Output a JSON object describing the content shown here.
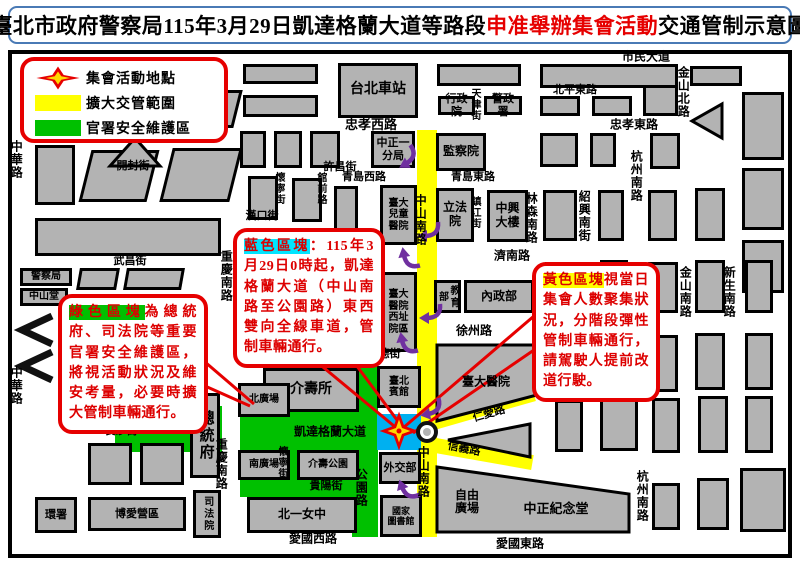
{
  "title": {
    "part1": "臺北市政府警察局115年3月29日凱達格蘭大道等路段",
    "accent": "申准舉辦集會活動",
    "part2": "交通管制示意圖"
  },
  "legend": {
    "items": [
      {
        "icon": "assembly-star-icon",
        "label": "集會活動地點"
      },
      {
        "icon": "yellow-zone-swatch",
        "label": "擴大交管範圍"
      },
      {
        "icon": "green-zone-swatch",
        "label": "官署安全維護區"
      }
    ]
  },
  "colors": {
    "building_gray": "#b3b3b3",
    "zone_yellow": "#ffff00",
    "zone_green": "#00c000",
    "zone_blue": "#00b0f0",
    "callout_red": "#e60000",
    "arrow_purple": "#7030a0",
    "title_border_blue": "#4a7ab5",
    "highlight_cyan": "#00e5ff",
    "star_red": "#e60000",
    "star_yellow": "#ffd800"
  },
  "map": {
    "zones": [
      {
        "n": "zone-yellow-zhongshan-s-rd",
        "x": 417,
        "y": 130,
        "w": 20,
        "h": 407,
        "c": "#ffff00"
      },
      {
        "n": "zone-yellow-renai-rd",
        "x": 430,
        "y": 416,
        "w": 108,
        "h": 15,
        "c": "#ffff00",
        "r": -16
      },
      {
        "n": "zone-yellow-xinyi-rd",
        "x": 430,
        "y": 437,
        "w": 104,
        "h": 15,
        "c": "#ffff00",
        "r": 10
      },
      {
        "n": "zone-green-west",
        "x": 115,
        "y": 406,
        "w": 107,
        "h": 46,
        "c": "#00c000"
      },
      {
        "n": "zone-green-ketagalan",
        "x": 240,
        "y": 410,
        "w": 138,
        "h": 42,
        "c": "#00c000"
      },
      {
        "n": "zone-green-south",
        "x": 240,
        "y": 452,
        "w": 138,
        "h": 45,
        "c": "#00c000"
      },
      {
        "n": "zone-green-gongyuan-n",
        "x": 352,
        "y": 362,
        "w": 26,
        "h": 48,
        "c": "#00c000"
      },
      {
        "n": "zone-green-gongyuan-s",
        "x": 352,
        "y": 497,
        "w": 26,
        "h": 40,
        "c": "#00c000"
      },
      {
        "n": "zone-blue-assembly",
        "x": 377,
        "y": 414,
        "w": 44,
        "h": 36,
        "c": "#00b0f0"
      }
    ],
    "buildings": [
      {
        "x": 35,
        "y": 88,
        "w": 40,
        "h": 45
      },
      {
        "x": 80,
        "y": 90,
        "w": 73,
        "h": 38,
        "sk": -14
      },
      {
        "x": 162,
        "y": 90,
        "w": 76,
        "h": 38,
        "sk": -14
      },
      {
        "x": 35,
        "y": 145,
        "w": 40,
        "h": 60
      },
      {
        "x": 85,
        "y": 150,
        "w": 68,
        "h": 52,
        "sk": -14
      },
      {
        "x": 166,
        "y": 148,
        "w": 70,
        "h": 54,
        "sk": -14
      },
      {
        "x": 35,
        "y": 218,
        "w": 186,
        "h": 38
      },
      {
        "x": 243,
        "y": 64,
        "w": 75,
        "h": 20
      },
      {
        "x": 243,
        "y": 95,
        "w": 75,
        "h": 22
      },
      {
        "x": 338,
        "y": 63,
        "w": 80,
        "h": 55,
        "t": "台北車站",
        "fs": 14
      },
      {
        "x": 437,
        "y": 64,
        "w": 84,
        "h": 22
      },
      {
        "x": 438,
        "y": 96,
        "w": 37,
        "h": 19,
        "t": "行政院",
        "fs": 11
      },
      {
        "x": 484,
        "y": 96,
        "w": 38,
        "h": 19,
        "t": "警政署",
        "fs": 11
      },
      {
        "x": 540,
        "y": 64,
        "w": 138,
        "h": 24
      },
      {
        "x": 540,
        "y": 96,
        "w": 40,
        "h": 20
      },
      {
        "x": 592,
        "y": 96,
        "w": 40,
        "h": 20
      },
      {
        "x": 643,
        "y": 85,
        "w": 35,
        "h": 31
      },
      {
        "x": 690,
        "y": 66,
        "w": 52,
        "h": 20
      },
      {
        "x": 742,
        "y": 92,
        "w": 42,
        "h": 68
      },
      {
        "x": 240,
        "y": 131,
        "w": 26,
        "h": 37
      },
      {
        "x": 274,
        "y": 131,
        "w": 28,
        "h": 37
      },
      {
        "x": 310,
        "y": 131,
        "w": 30,
        "h": 37
      },
      {
        "x": 371,
        "y": 131,
        "w": 44,
        "h": 37,
        "t": "中正一\n分局",
        "fs": 11
      },
      {
        "x": 436,
        "y": 133,
        "w": 50,
        "h": 38,
        "t": "監察院",
        "fs": 12
      },
      {
        "x": 540,
        "y": 133,
        "w": 38,
        "h": 34
      },
      {
        "x": 590,
        "y": 133,
        "w": 26,
        "h": 34
      },
      {
        "x": 650,
        "y": 133,
        "w": 30,
        "h": 36
      },
      {
        "x": 742,
        "y": 168,
        "w": 42,
        "h": 62
      },
      {
        "x": 248,
        "y": 176,
        "w": 30,
        "h": 44
      },
      {
        "x": 292,
        "y": 178,
        "w": 30,
        "h": 44
      },
      {
        "x": 334,
        "y": 186,
        "w": 24,
        "h": 56
      },
      {
        "x": 334,
        "y": 250,
        "w": 24,
        "h": 58
      },
      {
        "x": 334,
        "y": 312,
        "w": 22,
        "h": 40
      },
      {
        "x": 380,
        "y": 185,
        "w": 37,
        "h": 60,
        "t": "臺大\n兒童\n醫院",
        "fs": 10
      },
      {
        "x": 380,
        "y": 272,
        "w": 37,
        "h": 80,
        "t": "臺大\n醫院\n西址\n院區",
        "fs": 10
      },
      {
        "x": 436,
        "y": 188,
        "w": 38,
        "h": 54,
        "t": "立法院",
        "fs": 12
      },
      {
        "x": 487,
        "y": 190,
        "w": 41,
        "h": 52,
        "t": "中興\n大樓",
        "fs": 12
      },
      {
        "x": 543,
        "y": 190,
        "w": 34,
        "h": 51
      },
      {
        "x": 598,
        "y": 190,
        "w": 26,
        "h": 51
      },
      {
        "x": 648,
        "y": 190,
        "w": 29,
        "h": 51
      },
      {
        "x": 695,
        "y": 188,
        "w": 30,
        "h": 53
      },
      {
        "x": 742,
        "y": 240,
        "w": 42,
        "h": 53
      },
      {
        "x": 78,
        "y": 268,
        "w": 40,
        "h": 22,
        "sk": -10
      },
      {
        "x": 125,
        "y": 268,
        "w": 58,
        "h": 22,
        "sk": -10
      },
      {
        "x": 20,
        "y": 268,
        "w": 52,
        "h": 18,
        "t": "警察局",
        "fs": 10
      },
      {
        "x": 20,
        "y": 288,
        "w": 48,
        "h": 18,
        "t": "中山堂",
        "fs": 10
      },
      {
        "x": 434,
        "y": 280,
        "w": 27,
        "h": 33,
        "t": "教育部",
        "fs": 10,
        "v": true
      },
      {
        "x": 464,
        "y": 280,
        "w": 70,
        "h": 33,
        "t": "內政部",
        "fs": 12
      },
      {
        "x": 545,
        "y": 262,
        "w": 42,
        "h": 52
      },
      {
        "x": 600,
        "y": 260,
        "w": 28,
        "h": 53
      },
      {
        "x": 648,
        "y": 262,
        "w": 30,
        "h": 51
      },
      {
        "x": 695,
        "y": 260,
        "w": 30,
        "h": 53
      },
      {
        "x": 745,
        "y": 260,
        "w": 28,
        "h": 53
      },
      {
        "x": 543,
        "y": 333,
        "w": 44,
        "h": 57
      },
      {
        "x": 648,
        "y": 335,
        "w": 30,
        "h": 57
      },
      {
        "x": 695,
        "y": 333,
        "w": 30,
        "h": 57
      },
      {
        "x": 745,
        "y": 333,
        "w": 28,
        "h": 57
      },
      {
        "x": 377,
        "y": 366,
        "w": 44,
        "h": 42,
        "t": "臺北\n賓館",
        "fs": 10
      },
      {
        "x": 263,
        "y": 368,
        "w": 96,
        "h": 44,
        "t": "介壽所",
        "fs": 14
      },
      {
        "x": 238,
        "y": 383,
        "w": 52,
        "h": 34,
        "t": "北廣場",
        "fs": 10
      },
      {
        "x": 190,
        "y": 393,
        "w": 30,
        "h": 85,
        "t": "總統府",
        "fs": 15,
        "v": true
      },
      {
        "x": 88,
        "y": 443,
        "w": 44,
        "h": 42
      },
      {
        "x": 140,
        "y": 443,
        "w": 44,
        "h": 42
      },
      {
        "x": 555,
        "y": 400,
        "w": 28,
        "h": 52
      },
      {
        "x": 600,
        "y": 396,
        "w": 38,
        "h": 55
      },
      {
        "x": 652,
        "y": 398,
        "w": 28,
        "h": 55
      },
      {
        "x": 698,
        "y": 396,
        "w": 30,
        "h": 57
      },
      {
        "x": 745,
        "y": 396,
        "w": 28,
        "h": 57
      },
      {
        "x": 238,
        "y": 450,
        "w": 52,
        "h": 30,
        "t": "南廣場",
        "fs": 10
      },
      {
        "x": 297,
        "y": 450,
        "w": 62,
        "h": 30,
        "t": "介壽公園",
        "fs": 10
      },
      {
        "x": 379,
        "y": 452,
        "w": 42,
        "h": 32,
        "t": "外交部",
        "fs": 11
      },
      {
        "x": 193,
        "y": 490,
        "w": 28,
        "h": 48,
        "t": "司法院",
        "fs": 10,
        "v": true
      },
      {
        "x": 35,
        "y": 497,
        "w": 42,
        "h": 36,
        "t": "環署",
        "fs": 11
      },
      {
        "x": 88,
        "y": 497,
        "w": 98,
        "h": 34,
        "t": "博愛營區",
        "fs": 11
      },
      {
        "x": 247,
        "y": 497,
        "w": 110,
        "h": 36,
        "t": "北一女中",
        "fs": 12
      },
      {
        "x": 380,
        "y": 495,
        "w": 42,
        "h": 42,
        "t": "國家\n圖書館",
        "fs": 9
      },
      {
        "x": 652,
        "y": 483,
        "w": 28,
        "h": 47
      },
      {
        "x": 697,
        "y": 478,
        "w": 32,
        "h": 52
      },
      {
        "x": 740,
        "y": 468,
        "w": 46,
        "h": 64
      }
    ],
    "shapes": [
      {
        "n": "building-triangle",
        "pts": "135,138 160,166 110,166"
      },
      {
        "n": "building-triangle-left",
        "pts": "722,104 722,138 692,121"
      },
      {
        "n": "building-triangle-renai-xinyi",
        "pts": "448,440 530,424 530,457"
      },
      {
        "n": "building-ntu-hospital",
        "pts": "437,345 537,345 537,395 437,421"
      },
      {
        "n": "building-cks-memorial",
        "pts": "437,467 629,494 629,532 437,532"
      }
    ],
    "chevrons": [
      {
        "n": "road-chevron-icon",
        "pts": "52,316 22,330 52,344"
      },
      {
        "n": "road-chevron-icon",
        "pts": "52,352 22,366 52,380"
      }
    ],
    "labels": [
      {
        "t": "市民大道",
        "x": 646,
        "y": 57
      },
      {
        "t": "北平東路",
        "x": 575,
        "y": 90,
        "fs": 11
      },
      {
        "t": "忠孝西路",
        "x": 371,
        "y": 125,
        "fs": 13
      },
      {
        "t": "忠孝東路",
        "x": 634,
        "y": 125
      },
      {
        "t": "開封街",
        "x": 133,
        "y": 166,
        "fs": 11
      },
      {
        "t": "許昌街",
        "x": 340,
        "y": 167,
        "fs": 11
      },
      {
        "t": "青島西路",
        "x": 364,
        "y": 177,
        "fs": 11
      },
      {
        "t": "青島東路",
        "x": 473,
        "y": 177,
        "fs": 11
      },
      {
        "t": "漢口街",
        "x": 262,
        "y": 216,
        "fs": 11
      },
      {
        "t": "武昌街",
        "x": 130,
        "y": 261,
        "fs": 11
      },
      {
        "t": "濟南路",
        "x": 512,
        "y": 256
      },
      {
        "t": "徐州路",
        "x": 474,
        "y": 331
      },
      {
        "t": "常德街",
        "x": 384,
        "y": 354,
        "fs": 11
      },
      {
        "t": "長沙街",
        "x": 121,
        "y": 431,
        "fs": 11
      },
      {
        "t": "凱達格蘭大道",
        "x": 330,
        "y": 432
      },
      {
        "t": "貴陽街",
        "x": 326,
        "y": 486,
        "fs": 11
      },
      {
        "t": "愛國西路",
        "x": 313,
        "y": 539
      },
      {
        "t": "愛國東路",
        "x": 520,
        "y": 544
      },
      {
        "t": "仁愛路",
        "x": 489,
        "y": 414,
        "fs": 11,
        "r": -16
      },
      {
        "t": "信義路",
        "x": 464,
        "y": 449,
        "fs": 11,
        "r": 11
      },
      {
        "t": "自由\n廣場",
        "x": 467,
        "y": 502,
        "n": "area-label-liberty-square"
      },
      {
        "t": "中正紀念堂",
        "x": 556,
        "y": 509,
        "fs": 13,
        "n": "building-label-cks"
      },
      {
        "t": "臺大醫院",
        "x": 486,
        "y": 382,
        "n": "building-label-ntu-hospital"
      },
      {
        "t": "中華路",
        "x": 17,
        "y": 140,
        "v": true
      },
      {
        "t": "中華路",
        "x": 17,
        "y": 366,
        "v": true
      },
      {
        "t": "金山北路",
        "x": 684,
        "y": 66,
        "v": true
      },
      {
        "t": "天津街",
        "x": 477,
        "y": 88,
        "v": true,
        "fs": 10
      },
      {
        "t": "杭州南路",
        "x": 637,
        "y": 150,
        "v": true
      },
      {
        "t": "林森南路",
        "x": 532,
        "y": 192,
        "v": true
      },
      {
        "t": "紹興南街",
        "x": 585,
        "y": 190,
        "v": true
      },
      {
        "t": "鎮江街",
        "x": 477,
        "y": 196,
        "v": true,
        "fs": 10
      },
      {
        "t": "金山南路",
        "x": 686,
        "y": 266,
        "v": true
      },
      {
        "t": "新生南路",
        "x": 730,
        "y": 266,
        "v": true
      },
      {
        "t": "中山南路",
        "x": 421,
        "y": 194,
        "v": true
      },
      {
        "t": "中山南路",
        "x": 424,
        "y": 446,
        "v": true
      },
      {
        "t": "重慶南路",
        "x": 227,
        "y": 250,
        "v": true
      },
      {
        "t": "重慶南路",
        "x": 222,
        "y": 438,
        "v": true
      },
      {
        "t": "懷寧街",
        "x": 281,
        "y": 172,
        "v": true,
        "fs": 10
      },
      {
        "t": "館前路",
        "x": 323,
        "y": 172,
        "v": true,
        "fs": 10
      },
      {
        "t": "懷寧街",
        "x": 284,
        "y": 446,
        "v": true,
        "fs": 10
      },
      {
        "t": "公園路",
        "x": 362,
        "y": 300,
        "v": true
      },
      {
        "t": "公園路",
        "x": 362,
        "y": 468,
        "v": true
      },
      {
        "t": "桃源街",
        "x": 127,
        "y": 390,
        "v": true,
        "fs": 10
      },
      {
        "t": "杭州南路",
        "x": 643,
        "y": 470,
        "v": true
      }
    ],
    "arrows": [
      {
        "x": 404,
        "y": 158,
        "r": -30
      },
      {
        "x": 426,
        "y": 230,
        "r": 0
      },
      {
        "x": 410,
        "y": 255,
        "r": 80
      },
      {
        "x": 428,
        "y": 312,
        "r": 0
      },
      {
        "x": 408,
        "y": 340,
        "r": 80
      },
      {
        "x": 428,
        "y": 408,
        "r": -10
      },
      {
        "x": 408,
        "y": 486,
        "r": 70
      }
    ],
    "pointer_lines": [
      {
        "x1": 300,
        "y1": 348,
        "x2": 394,
        "y2": 426
      },
      {
        "x1": 345,
        "y1": 350,
        "x2": 400,
        "y2": 424
      },
      {
        "x1": 534,
        "y1": 316,
        "x2": 403,
        "y2": 428
      },
      {
        "x1": 534,
        "y1": 350,
        "x2": 413,
        "y2": 433
      },
      {
        "x1": 205,
        "y1": 362,
        "x2": 254,
        "y2": 404
      },
      {
        "x1": 205,
        "y1": 386,
        "x2": 250,
        "y2": 406
      }
    ],
    "callouts": [
      {
        "id": "blue-zone-callout",
        "x": 233,
        "y": 228,
        "w": 152,
        "hl": "藍色區塊",
        "hl_bg": "#00e5ff",
        "text": "：115年3月29日0時起，凱達格蘭大道（中山南路至公園路）東西雙向全線車道，管制車輛通行。"
      },
      {
        "id": "green-zone-callout",
        "x": 58,
        "y": 294,
        "w": 150,
        "hl": "綠色區塊",
        "hl_bg": "#00c000",
        "text": "為總統府、司法院等重要官署安全維護區，將視活動狀況及維安考量，必要時擴大管制車輛通行。"
      },
      {
        "id": "yellow-zone-callout",
        "x": 532,
        "y": 262,
        "w": 128,
        "hl": "黃色區塊",
        "hl_bg": "#ffff00",
        "text": "視當日集會人數聚集狀況，分階段彈性管制車輛通行，請駕駛人提前改道行駛。"
      }
    ],
    "star": {
      "n": "assembly-location-star",
      "x": 399,
      "y": 431
    },
    "roundabout": {
      "n": "roundabout-icon",
      "x": 427,
      "y": 432
    }
  }
}
